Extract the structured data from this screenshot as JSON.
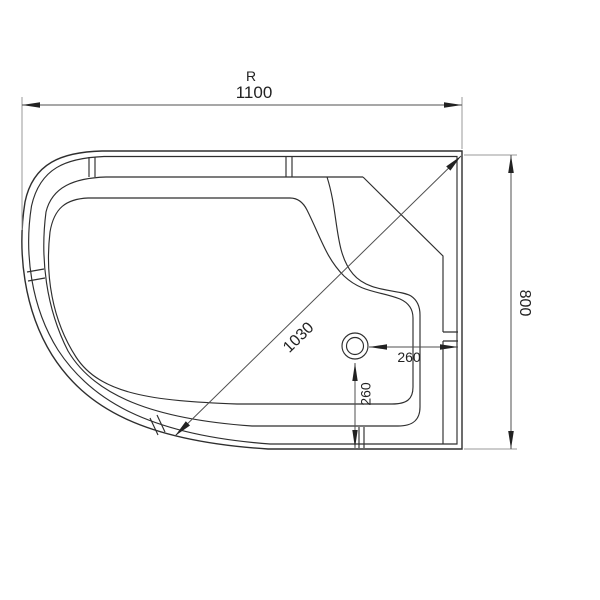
{
  "drawing": {
    "description": "technical top view drawing of offset quadrant shower tray with drain",
    "labels": {
      "radius_prefix": "R",
      "overall_width": "1100",
      "overall_depth": "800",
      "diagonal": "1030",
      "drain_offset_horizontal": "260",
      "drain_offset_vertical": "260"
    },
    "colors": {
      "background": "#ffffff",
      "outline": "#2e2e2e",
      "dimension_line": "#4f4f4f",
      "extension_line": "#9a9a9a",
      "text": "#222222"
    }
  }
}
